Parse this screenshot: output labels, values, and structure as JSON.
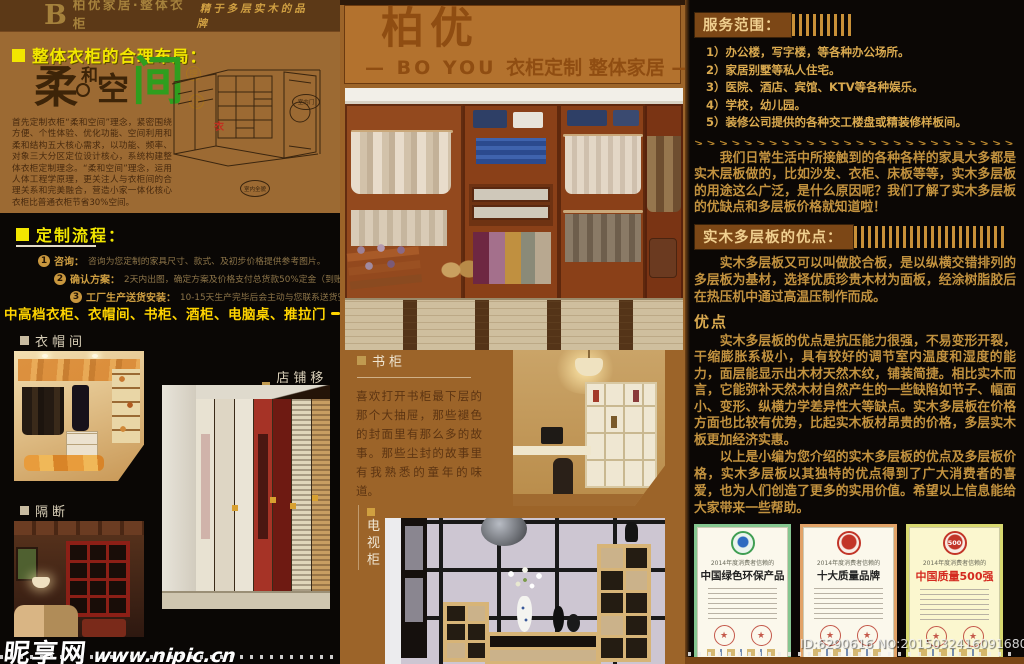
{
  "brand": {
    "letter": "B",
    "name_cn": "柏优家居·整体衣柜",
    "name_en": "BO YOU JIA JU    ZHENG TI YI GUI",
    "slogan": "精于多层实木的品牌",
    "accent_yellow": "#f2e600",
    "gold": "#c9973e",
    "panel_brown": "#9c6a33",
    "mid_brown": "#9c6429"
  },
  "left": {
    "layout": {
      "heading": "整体衣柜的合理布局：",
      "art_chars": {
        "rou": "柔",
        "he": "和",
        "kong": "空",
        "jian": "间",
        "li": "理",
        "nian": "念"
      },
      "drawing_bubble_top": "室内门",
      "drawing_bubble_bottom": "室内全貌",
      "drawing_mark": "衣",
      "paragraph": "首先定制衣柜“柔和空间”理念，紧密围绕方便、个性体验、优化功能、空间利用和柔和结构五大核心需求，以功能、频率、对象三大分区定位设计核心，系统构建整体衣柜定制理念。“柔和空间”理念，运用人体工程学原理，更关注人与衣柜间的合理关系和完美融合，营造小家一体化核心衣柜比普通衣柜节省30%空间。"
    },
    "process": {
      "heading": "定制流程：",
      "steps": [
        {
          "num": "1",
          "label": "咨询：",
          "text": "咨询为您定制的家具尺寸、款式、及初步价格提供参考图片。"
        },
        {
          "num": "2",
          "label": "确认方案：",
          "text": "2天内出图，确定方案及价格支付总货款50%定金（到账）。"
        },
        {
          "num": "3",
          "label": "工厂生产送货安装：",
          "text": "10-15天生产完毕后会主动与您联系送货安装时间。"
        }
      ]
    },
    "banner": {
      "text": "中高档衣柜、衣帽间、书柜、酒柜、电脑桌、推拉门"
    },
    "gallery": {
      "label_walkin": "衣帽间",
      "label_doors": "店铺移门",
      "label_partition": "隔断"
    }
  },
  "middle": {
    "header": {
      "title": "柏优",
      "subtitle_en": "— BO YOU ",
      "subtitle_cn": "衣柜定制 整体家居 —"
    },
    "bookcase": {
      "label": "书柜",
      "paragraph": "喜欢打开书柜最下层的那个大抽屉，那些褪色的封面里有那么多的故事。那些尘封的故事里有我熟悉的童年的味道。"
    },
    "tv": {
      "label_chars": [
        "电",
        "视",
        "柜"
      ]
    }
  },
  "right": {
    "service": {
      "heading": "服务范围：",
      "items": [
        "1）办公楼，写字楼，等各种办公场所。",
        "2）家居别墅等私人住宅。",
        "3）医院、酒店、宾馆、KTV等各种娱乐。",
        "4）学校，幼儿园。",
        "5）装修公司提供的各种交工楼盘或精装修样板间。"
      ]
    },
    "arrow_row": ">>>>>>>>>>>>>>>>>>>>>>>>>>>>>>>>",
    "intro": "　　我们日常生活中所接触到的各种各样的家具大多都是实木层板做的，比如沙发、衣柜、床板等等，实木多层板的用途这么广泛，是什么原因呢？我们了解了实木多层板的优缺点和多层板价格就知道啦！",
    "advantage": {
      "heading": "实木多层板的优点：",
      "definition": "　　实木多层板又可以叫做胶合板，是以纵横交错排列的多层板为基材，选择优质珍贵木材为面板，经涂树脂胶后在热压机中通过高温压制作而成。",
      "subheading": "优点",
      "detail": "　　实木多层板的优点是抗压能力很强，不易变形开裂，干缩膨胀系极小，具有较好的调节室内温度和湿度的能力，面层能显示出木材天然木纹，铺装简捷。相比实木而言，它能弥补天然木材自然产生的一些缺陷如节子、幅面小、变形、纵横力学差异性大等缺点。实木多层板在价格方面也比较有优势，比起实木板材昂贵的价格，多层实木板更加经济实惠。",
      "summary": "　　以上是小编为您介绍的实木多层板的优点及多层板价格，实木多层板以其独特的优点得到了广大消费者的喜爱，也为人们创造了更多的实用价值。希望以上信息能给大家带来一些帮助。"
    },
    "certificates": [
      {
        "year": "2014年度消费者信赖的",
        "title": "中国绿色环保产品",
        "seal_text": ""
      },
      {
        "year": "2014年度消费者信赖的",
        "title": "十大质量品牌",
        "seal_text": ""
      },
      {
        "year": "2014年度消费者信赖的",
        "title": "中国质量500强",
        "seal_text": "500"
      }
    ]
  },
  "watermarks": {
    "site_name": "昵享网",
    "site_url": "www.nipic.cn",
    "id_line": "ID:6290616 NO:20150324160916803000"
  }
}
